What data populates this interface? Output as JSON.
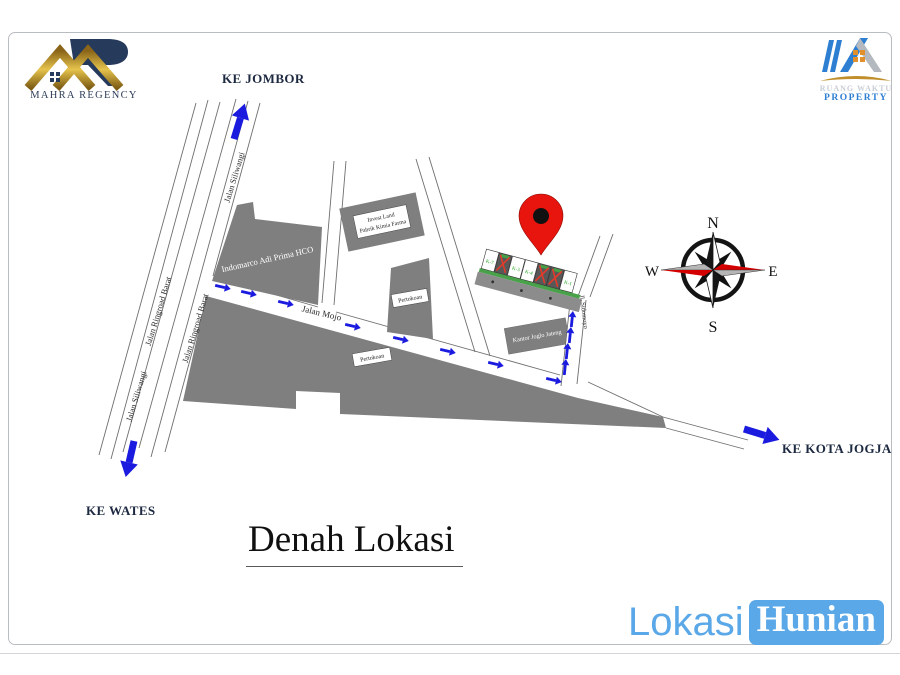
{
  "header": {
    "mahra_logo": {
      "brand": "MAHRA REGENCY"
    },
    "ruang_waktu_logo": {
      "line1": "RUANG WAKTU",
      "line2": "PROPERTY"
    }
  },
  "map": {
    "directions": {
      "north": "KE JOMBOR",
      "south": "KE WATES",
      "east": "KE KOTA JOGJA"
    },
    "roads": {
      "siliwangi_upper": "Jalan Siliwangi",
      "siliwangi_lower": "Jalan Siliwangi",
      "ringroad_west": "Jalan Ringroad Barat",
      "ringroad_east": "Jalan Ringroad Barat",
      "mojo": "Jalan Mojo",
      "sidomoyo": "Jl. Sidomoyo"
    },
    "buildings": {
      "indomarco": "Indomarco Adi Prima HCO",
      "invest_land_line1": "Invest Land",
      "invest_land_line2": "Pabrik Kimia Farma",
      "pertokoan_north": "Pertokoan",
      "pertokoan_south": "Pertokoan",
      "kantor_joglo": "Kantor Joglo Jateng"
    },
    "site_plan": {
      "lots": [
        {
          "label": "K-7",
          "status": "available"
        },
        {
          "label": "",
          "status": "sold"
        },
        {
          "label": "K-3",
          "status": "available"
        },
        {
          "label": "K-4",
          "status": "available"
        },
        {
          "label": "",
          "status": "sold"
        },
        {
          "label": "",
          "status": "sold"
        },
        {
          "label": "K-1",
          "status": "available"
        }
      ]
    },
    "compass": {
      "north": "N",
      "south": "S",
      "east": "E",
      "west": "W"
    }
  },
  "title": "Denah Lokasi",
  "footer": {
    "brand_first": "Lokasi",
    "brand_second": "Hunian"
  },
  "colors": {
    "arrow_blue": "#1b1bdf",
    "building_gray": "#7f7f7f",
    "pin_red": "#e8150f",
    "brand_blue": "#5aa8e8",
    "compass_red": "#d40000",
    "lot_green": "#18a018",
    "gold": "#c39a38",
    "navy": "#263a5c",
    "text_dark": "#1c2940"
  },
  "icons": {
    "map_pin": "location-pin",
    "direction_arrow": "blue-arrow",
    "compass": "compass-rose"
  }
}
